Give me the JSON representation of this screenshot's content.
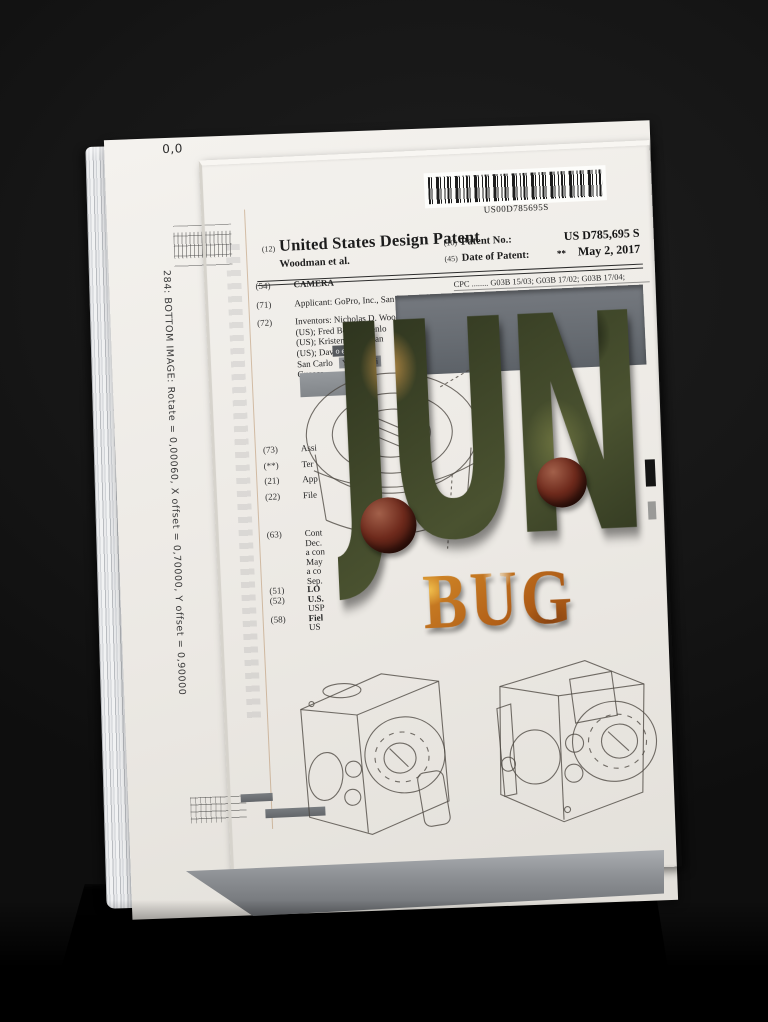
{
  "scene": {
    "marker": "0,0",
    "spine": "284: BOTTOM IMAGE: Rotate = 0,00060, X offset = 0,70000, Y offset = 0,90000",
    "background_color": "#141414",
    "paper_color": "#ece9e4",
    "recess_color": "#676c72"
  },
  "patent": {
    "barcode_text": "US00D785695S",
    "header": {
      "code": "(12)",
      "title": "United States Design Patent",
      "authors": "Woodman et al.",
      "no_code": "(10)",
      "no_label": "Patent No.:",
      "no_value": "US D785,695 S",
      "date_code": "(45)",
      "date_label": "Date of Patent:",
      "date_stars": "**",
      "date_value": "May 2, 2017"
    },
    "cpc": "CPC ........ G03B 15/03; G03B 17/02; G03B 17/04;",
    "fragments": [
      "o et al.",
      "Yamaguchi"
    ],
    "rows": [
      {
        "c": "(54)",
        "t": "CAMERA"
      },
      {
        "c": "(71)",
        "t": "Applicant: GoPro, Inc., San Mateo, C"
      },
      {
        "c": "(72)",
        "t": "Inventors: Nicholas D. Woodman, W"
      },
      {
        "c": "",
        "t": "(US); Fred Bould, Menlo"
      },
      {
        "c": "",
        "t": "(US); Kristen Beck, San"
      },
      {
        "c": "",
        "t": "(US); Dav"
      },
      {
        "c": "",
        "t": "San Carlo"
      },
      {
        "c": "",
        "t": "Guasca,"
      },
      {
        "c": "(73)",
        "t": "Assi"
      },
      {
        "c": "(**)",
        "t": "Ter"
      },
      {
        "c": "(21)",
        "t": "App"
      },
      {
        "c": "(22)",
        "t": "File"
      },
      {
        "c": "(63)",
        "t": "Cont"
      },
      {
        "c": "",
        "t": "Dec."
      },
      {
        "c": "",
        "t": "a con"
      },
      {
        "c": "",
        "t": "May"
      },
      {
        "c": "",
        "t": "a co"
      },
      {
        "c": "",
        "t": "Sep."
      },
      {
        "c": "(51)",
        "t": "LO"
      },
      {
        "c": "(52)",
        "t": "U.S."
      },
      {
        "c": "",
        "t": "USP"
      },
      {
        "c": "(58)",
        "t": "Fiel"
      },
      {
        "c": "",
        "t": "US"
      }
    ]
  },
  "art": {
    "word_top": "JUN",
    "word_bottom": "BUG",
    "camo_colors": [
      "#202615",
      "#3c4426",
      "#6d7340",
      "#97a054",
      "#b98c45"
    ],
    "bug_colors": [
      "#f2c14e",
      "#e09a2f",
      "#b05e17",
      "#7a3c10"
    ],
    "sphere_color": "#6e2a1c"
  }
}
